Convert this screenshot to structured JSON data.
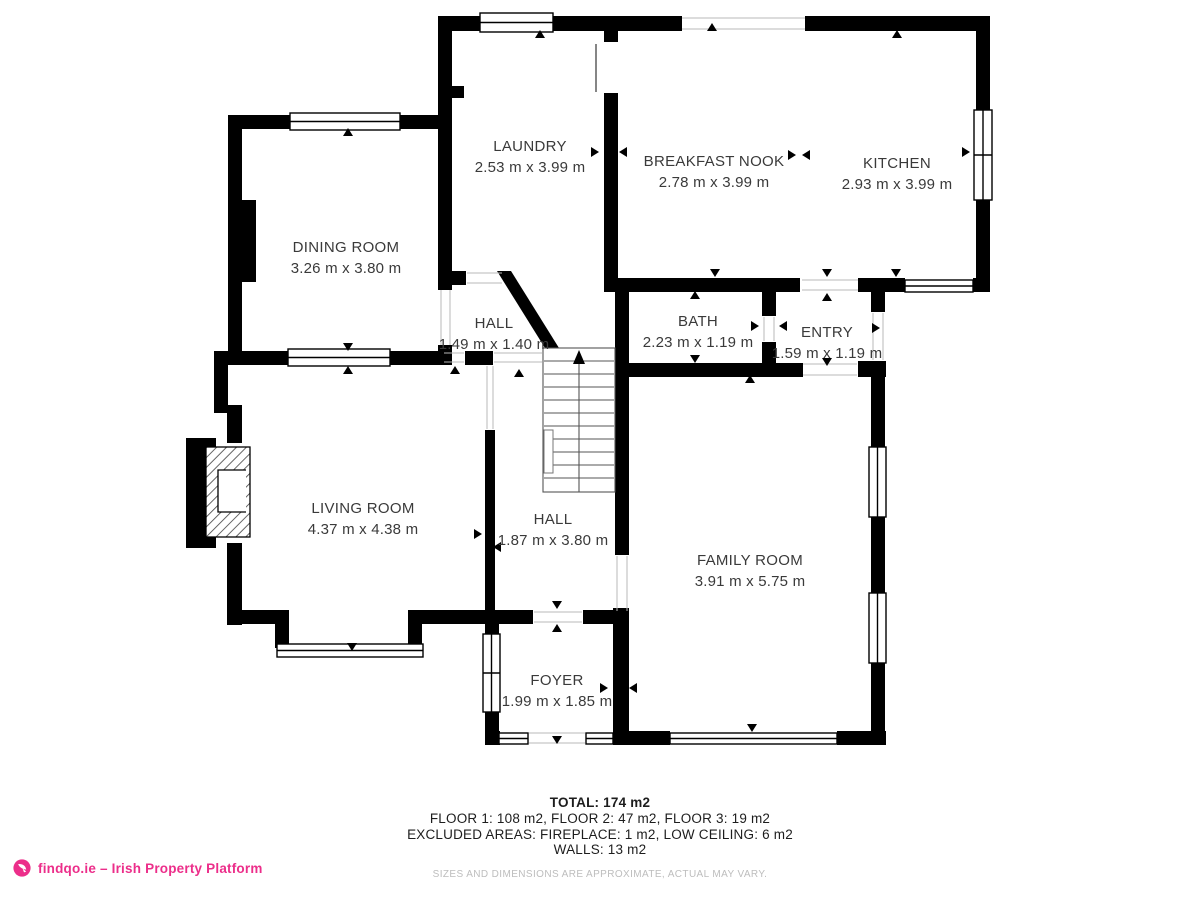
{
  "plan": {
    "rooms": [
      {
        "id": "laundry",
        "name": "LAUNDRY",
        "dims": "2.53 m x 3.99 m"
      },
      {
        "id": "breakfast-nook",
        "name": "BREAKFAST NOOK",
        "dims": "2.78 m x 3.99 m"
      },
      {
        "id": "kitchen",
        "name": "KITCHEN",
        "dims": "2.93 m x 3.99 m"
      },
      {
        "id": "dining-room",
        "name": "DINING ROOM",
        "dims": "3.26 m x 3.80 m"
      },
      {
        "id": "hall-upper",
        "name": "HALL",
        "dims": "1.49 m x 1.40 m"
      },
      {
        "id": "bath",
        "name": "BATH",
        "dims": "2.23 m x 1.19 m"
      },
      {
        "id": "entry",
        "name": "ENTRY",
        "dims": "1.59 m x 1.19 m"
      },
      {
        "id": "living-room",
        "name": "LIVING ROOM",
        "dims": "4.37 m x 4.38 m"
      },
      {
        "id": "hall-lower",
        "name": "HALL",
        "dims": "1.87 m x 3.80 m"
      },
      {
        "id": "family-room",
        "name": "FAMILY ROOM",
        "dims": "3.91 m x 5.75 m"
      },
      {
        "id": "foyer",
        "name": "FOYER",
        "dims": "1.99 m x 1.85 m"
      }
    ],
    "summary": {
      "total": "TOTAL: 174 m2",
      "floors": "FLOOR 1: 108 m2, FLOOR 2: 47 m2, FLOOR 3: 19 m2",
      "excluded": "EXCLUDED AREAS: FIREPLACE: 1 m2, LOW CEILING: 6 m2",
      "walls": "WALLS: 13 m2",
      "disclaimer": "SIZES AND DIMENSIONS ARE APPROXIMATE, ACTUAL MAY VARY."
    }
  },
  "footer": {
    "brand": "findqo.ie – Irish Property Platform"
  },
  "colors": {
    "wall": "#000000",
    "accent_pink": "#EC2E8A",
    "label_text": "#3a3a3a",
    "disclaimer_text": "#bdbdbd"
  }
}
